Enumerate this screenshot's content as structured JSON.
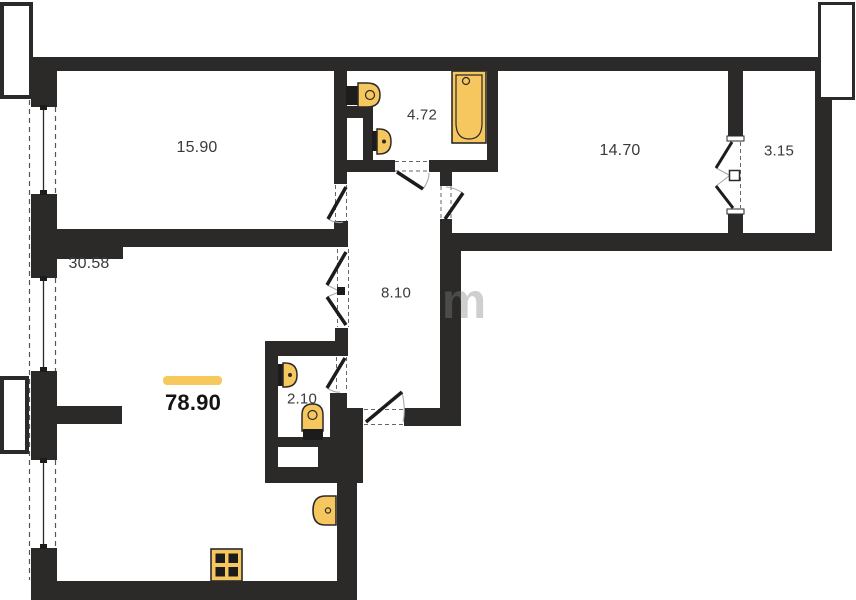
{
  "floorplan": {
    "title": "apartment floor plan",
    "total_area": "78.90",
    "rooms": [
      {
        "id": "bedroom-top-left",
        "area": "15.90"
      },
      {
        "id": "bathroom",
        "area": "4.72"
      },
      {
        "id": "bedroom-right",
        "area": "14.70"
      },
      {
        "id": "balcony",
        "area": "3.15"
      },
      {
        "id": "living-kitchen",
        "area": "30.58"
      },
      {
        "id": "hallway",
        "area": "8.10"
      },
      {
        "id": "wc",
        "area": "2.10"
      }
    ],
    "watermark": "m",
    "colors": {
      "wall": "#2b2a28",
      "fixture_fill": "#f6c75f",
      "accent_bar": "#f6c85e",
      "background": "#ffffff"
    }
  }
}
